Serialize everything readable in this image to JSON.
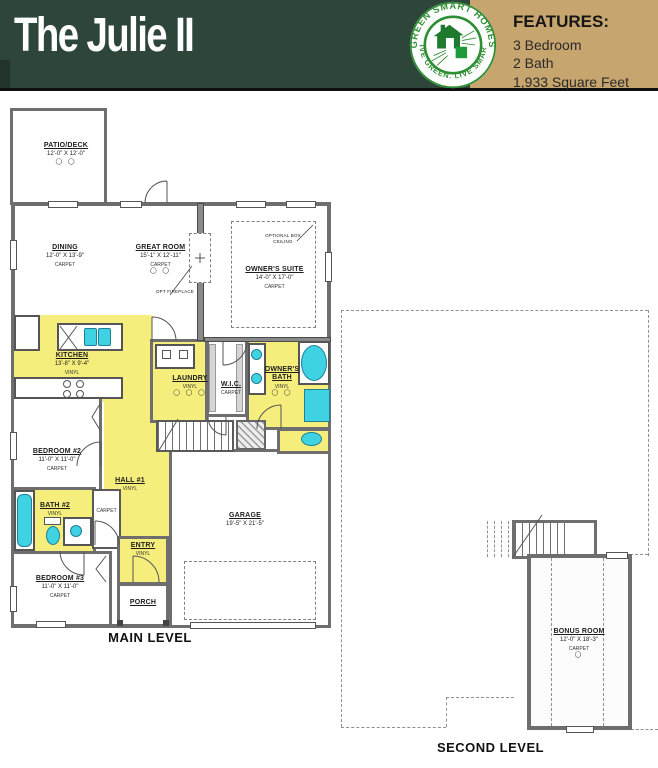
{
  "header": {
    "title": "The Julie II",
    "features_heading": "FEATURES:",
    "features": [
      "3 Bedroom",
      "2 Bath",
      "1,933 Square Feet"
    ],
    "logo": {
      "arc_top": "GREEN SMART HOMES",
      "arc_bottom": "LIVE GREEN. LIVE SMART."
    }
  },
  "colors": {
    "header_green": "#2e463a",
    "header_tan": "#c7a56e",
    "room_highlight_yellow": "#f5ee7d",
    "fixture_cyan": "#3fd2e2",
    "wall_gray": "#6e6e6e",
    "logo_green": "#2f8f35"
  },
  "main_level": {
    "title": "MAIN LEVEL",
    "rooms": {
      "patio": {
        "name": "PATIO/DECK",
        "dims": "12'-0\" X 12'-0\"",
        "symbols": "◯ ◯"
      },
      "dining": {
        "name": "DINING",
        "dims": "12'-0\" X 13'-9\"",
        "floor": "CARPET"
      },
      "great_room": {
        "name": "GREAT ROOM",
        "dims": "15'-1\" X 12'-11\"",
        "floor": "CARPET",
        "symbols": "◯ ◯"
      },
      "owners_suite": {
        "name": "OWNER'S SUITE",
        "dims": "14'-0\" X 17'-0\"",
        "floor": "CARPET"
      },
      "kitchen": {
        "name": "KITCHEN",
        "dims": "13'-8\" X 9'-4\"",
        "floor": "VINYL"
      },
      "laundry": {
        "name": "LAUNDRY",
        "floor": "VINYL",
        "symbols": "◯ ◯ ◯"
      },
      "wic": {
        "name": "W.I.C.",
        "floor": "CARPET"
      },
      "owners_bath": {
        "name": "OWNER'S BATH",
        "floor": "VINYL",
        "symbols": "◯ ◯"
      },
      "bedroom2": {
        "name": "BEDROOM #2",
        "dims": "11'-0\" X 11'-0\"",
        "floor": "CARPET"
      },
      "hall1": {
        "name": "HALL #1",
        "floor": "VINYL"
      },
      "hall_closet": {
        "floor": "CARPET"
      },
      "bath2": {
        "name": "BATH #2",
        "floor": "VINYL"
      },
      "bedroom3": {
        "name": "BEDROOM #3",
        "dims": "11'-0\" X 11'-0\"",
        "floor": "CARPET"
      },
      "entry": {
        "name": "ENTRY",
        "floor": "VINYL"
      },
      "porch": {
        "name": "PORCH"
      },
      "garage": {
        "name": "GARAGE",
        "dims": "19'-5\" X 21'-5\""
      }
    },
    "annotations": {
      "fireplace": "OPT FIREPLACE",
      "box_ceiling": "OPTIONAL BOX CEILING"
    }
  },
  "second_level": {
    "title": "SECOND LEVEL",
    "rooms": {
      "bonus": {
        "name": "BONUS ROOM",
        "dims": "12'-0\" X 18'-3\"",
        "floor": "CARPET",
        "symbols": "◯"
      }
    }
  }
}
